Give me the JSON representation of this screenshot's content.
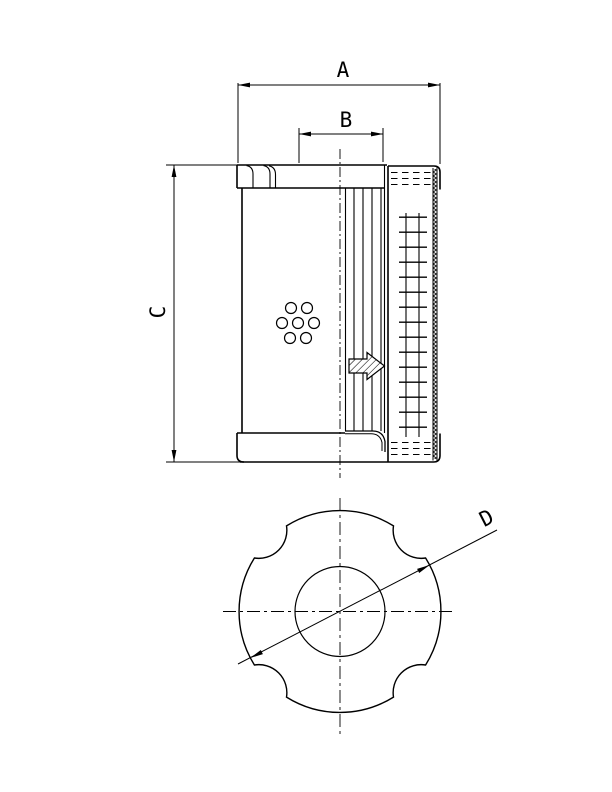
{
  "page": {
    "background_color": "#ffffff",
    "line_color": "#000000"
  },
  "drawing": {
    "kind": "filter-element-dimensional-drawing",
    "dimension_labels": {
      "a": "A",
      "b": "B",
      "c": "C",
      "d": "D"
    },
    "views": [
      {
        "name": "side-section-view",
        "dimensions": [
          "A",
          "B",
          "C"
        ]
      },
      {
        "name": "bottom-view",
        "dimensions": [
          "D"
        ]
      }
    ]
  }
}
